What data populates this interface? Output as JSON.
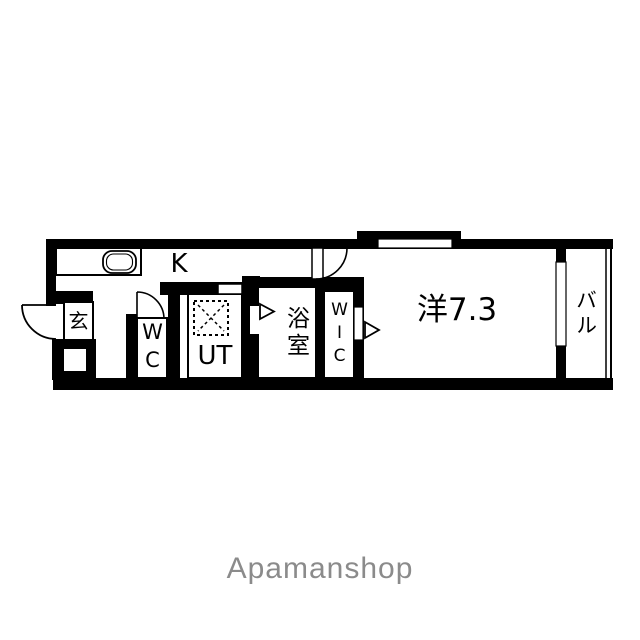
{
  "floor_plan": {
    "rooms": {
      "kitchen": {
        "label": "K"
      },
      "entrance": {
        "label": "玄"
      },
      "toilet": {
        "label": "WC"
      },
      "utility": {
        "label": "UT"
      },
      "bathroom": {
        "label": "浴室"
      },
      "walk_in_closet": {
        "label": "WIC"
      },
      "western_room": {
        "label": "洋7.3",
        "size_tatami": "7.3"
      },
      "balcony": {
        "label": "バル"
      }
    },
    "icons": {
      "entrance_door": "quarter-arc-door-swing",
      "toilet_door": "quarter-arc-door-swing",
      "room_door": "quarter-arc-door-swing",
      "bathroom_door_arrow": "▷",
      "wic_door_arrow": "▷",
      "washer_pan": "dashed-square-with-x",
      "kitchen_sink": "rounded-rectangle"
    },
    "colors": {
      "walls": "#000000",
      "floor": "#ffffff"
    }
  },
  "watermark": {
    "text": "Apamanshop",
    "color": "#8b8b8b"
  }
}
